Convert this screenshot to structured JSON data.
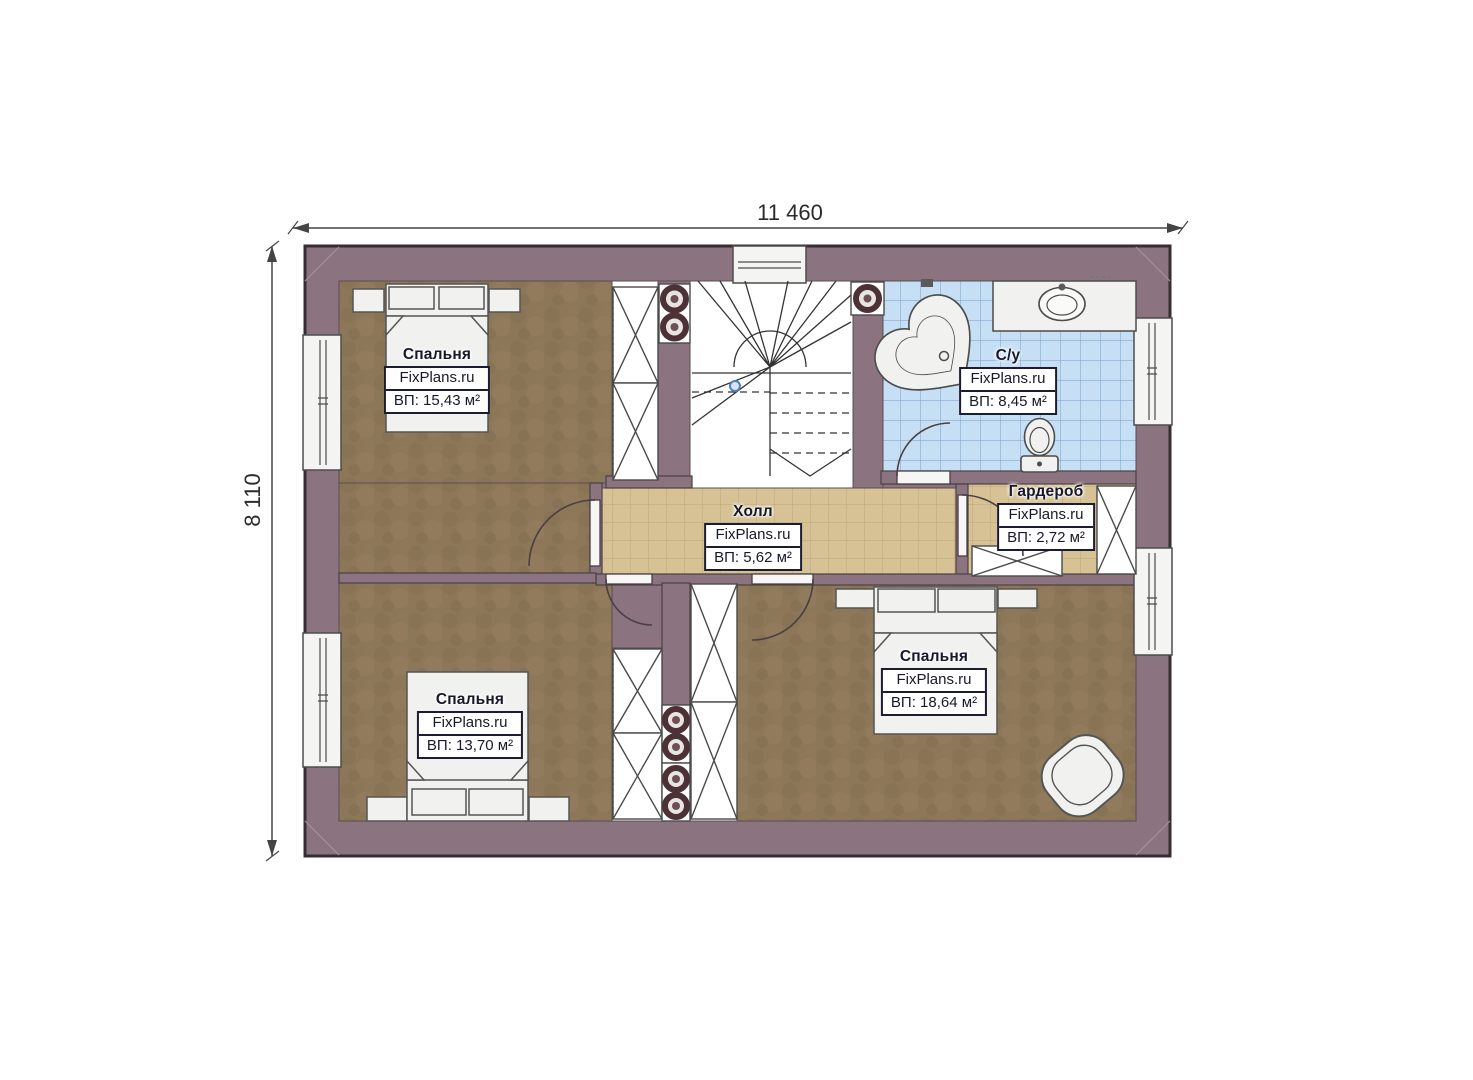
{
  "dimensions": {
    "top": "11 460",
    "left": "8 110"
  },
  "watermark": "FixPlans.ru",
  "rooms": [
    {
      "name": "Спальня",
      "brand": "FixPlans.ru",
      "area": "ВП: 15,43 м²"
    },
    {
      "name": "С/у",
      "brand": "FixPlans.ru",
      "area": "ВП: 8,45 м²"
    },
    {
      "name": "Холл",
      "brand": "FixPlans.ru",
      "area": "ВП: 5,62 м²"
    },
    {
      "name": "Гардероб",
      "brand": "FixPlans.ru",
      "area": "ВП: 2,72 м²"
    },
    {
      "name": "Спальня",
      "brand": "FixPlans.ru",
      "area": "ВП: 13,70 м²"
    },
    {
      "name": "Спальня",
      "brand": "FixPlans.ru",
      "area": "ВП: 18,64 м²"
    }
  ],
  "colors": {
    "wall": "#8b7380",
    "wall_outline": "#352d31",
    "bedroom_floor": "#8d7759",
    "hall_tile": "#d6c295",
    "bath_tile": "#c7dff4",
    "bath_tile_grid": "#84abd2",
    "fixture_fill": "#f1f1ef",
    "label_text": "#18182c",
    "stair_marker": "#4f7fbe"
  }
}
